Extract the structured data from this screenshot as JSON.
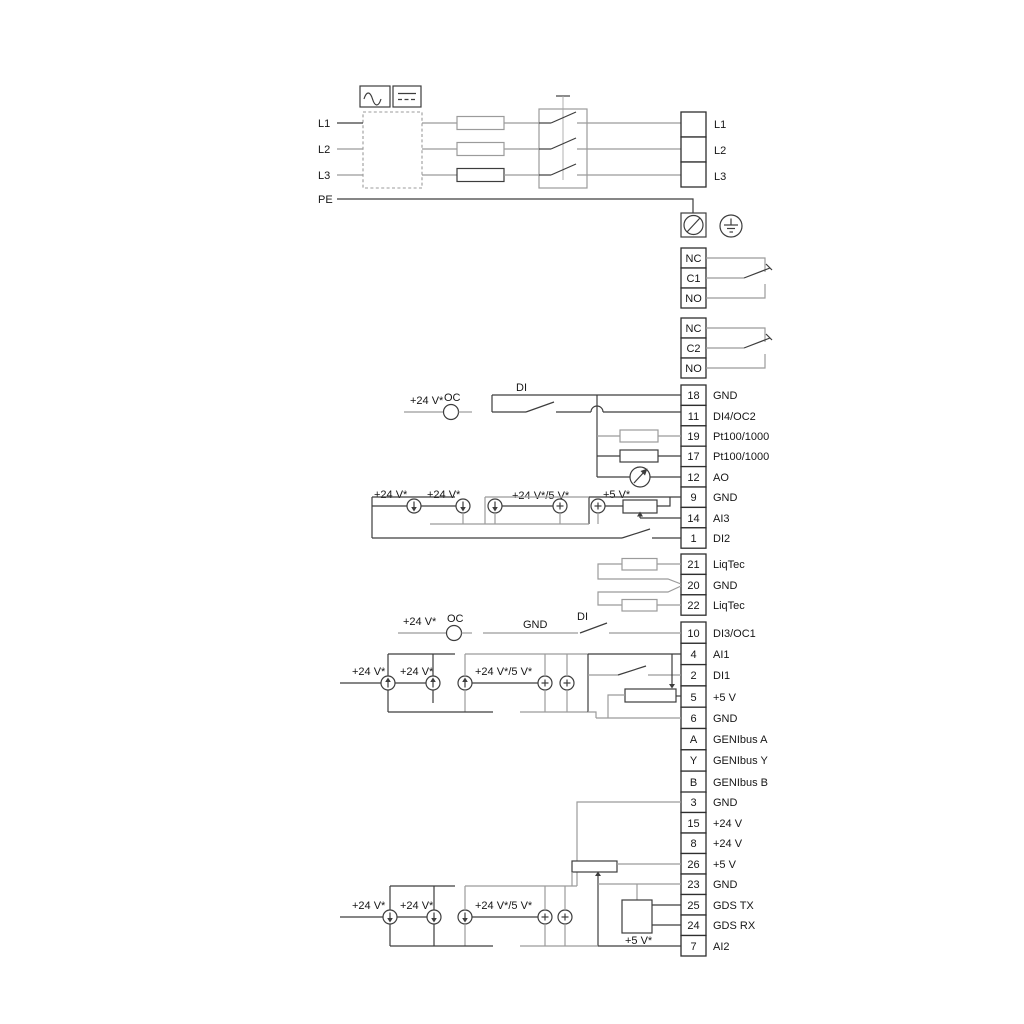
{
  "title": "Pump drive terminal wiring diagram",
  "power": {
    "inputs": [
      "L1",
      "L2",
      "L3"
    ],
    "pe": "PE",
    "outputs": [
      "L1",
      "L2",
      "L3"
    ]
  },
  "relay1": {
    "rows": [
      "NC",
      "C1",
      "NO"
    ]
  },
  "relay2": {
    "rows": [
      "NC",
      "C2",
      "NO"
    ]
  },
  "io1": {
    "rows": [
      {
        "num": "18",
        "label": "GND"
      },
      {
        "num": "11",
        "label": "DI4/OC2"
      },
      {
        "num": "19",
        "label": "Pt100/1000"
      },
      {
        "num": "17",
        "label": "Pt100/1000"
      },
      {
        "num": "12",
        "label": "AO"
      },
      {
        "num": "9",
        "label": "GND"
      },
      {
        "num": "14",
        "label": "AI3"
      },
      {
        "num": "1",
        "label": "DI2"
      }
    ]
  },
  "io2": {
    "rows": [
      {
        "num": "21",
        "label": "LiqTec"
      },
      {
        "num": "20",
        "label": "GND"
      },
      {
        "num": "22",
        "label": "LiqTec"
      }
    ]
  },
  "io3": {
    "rows": [
      {
        "num": "10",
        "label": "DI3/OC1"
      },
      {
        "num": "4",
        "label": "AI1"
      },
      {
        "num": "2",
        "label": "DI1"
      },
      {
        "num": "5",
        "label": "+5 V"
      },
      {
        "num": "6",
        "label": "GND"
      },
      {
        "num": "A",
        "label": "GENIbus A"
      },
      {
        "num": "Y",
        "label": "GENIbus Y"
      },
      {
        "num": "B",
        "label": "GENIbus B"
      }
    ]
  },
  "io4": {
    "rows": [
      {
        "num": "3",
        "label": "GND"
      },
      {
        "num": "15",
        "label": "+24 V"
      },
      {
        "num": "8",
        "label": "+24 V"
      },
      {
        "num": "26",
        "label": "+5 V"
      },
      {
        "num": "23",
        "label": "GND"
      },
      {
        "num": "25",
        "label": "GDS TX"
      },
      {
        "num": "24",
        "label": "GDS RX"
      },
      {
        "num": "7",
        "label": "AI2"
      }
    ]
  },
  "annotations": {
    "plus24": "+24 V*",
    "plus24or5": "+24 V*/5 V*",
    "plus5": "+5 V*",
    "oc": "OC",
    "di": "DI",
    "gnd": "GND"
  },
  "colors": {
    "line_dark": "#3d3d3d",
    "line_gray": "#9b9b9b",
    "text": "#161616",
    "background": "#ffffff"
  }
}
